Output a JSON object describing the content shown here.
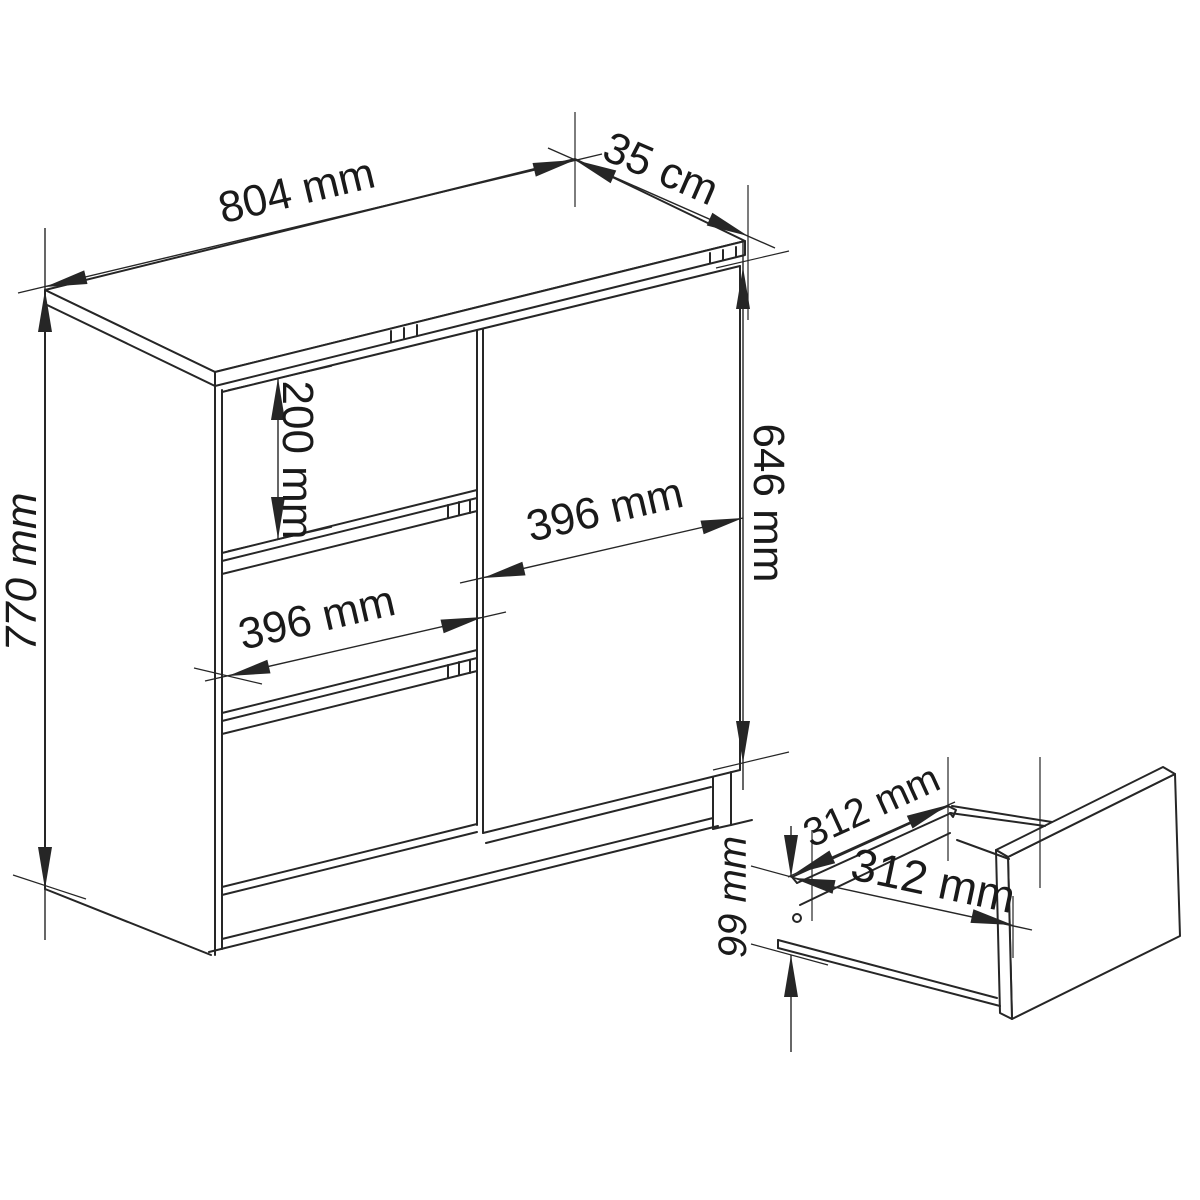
{
  "drawing": {
    "type": "furniture-technical-drawing",
    "subject": "chest of drawers with 3 drawers and 1 door, plus pulled-out drawer box detail",
    "colors": {
      "background": "#ffffff",
      "lines": "#262626",
      "text": "#1a1a1a"
    },
    "cabinet_view": {
      "width_label": "804 mm",
      "depth_label": "35 cm",
      "height_label": "770 mm",
      "top_drawer_label": "200 mm",
      "drawer_width_label": "396 mm",
      "door_width_label": "396 mm",
      "door_height_label": "646 mm"
    },
    "drawer_view": {
      "depth_label": "312 mm",
      "width_label": "312 mm",
      "height_label": "99 mm"
    }
  }
}
